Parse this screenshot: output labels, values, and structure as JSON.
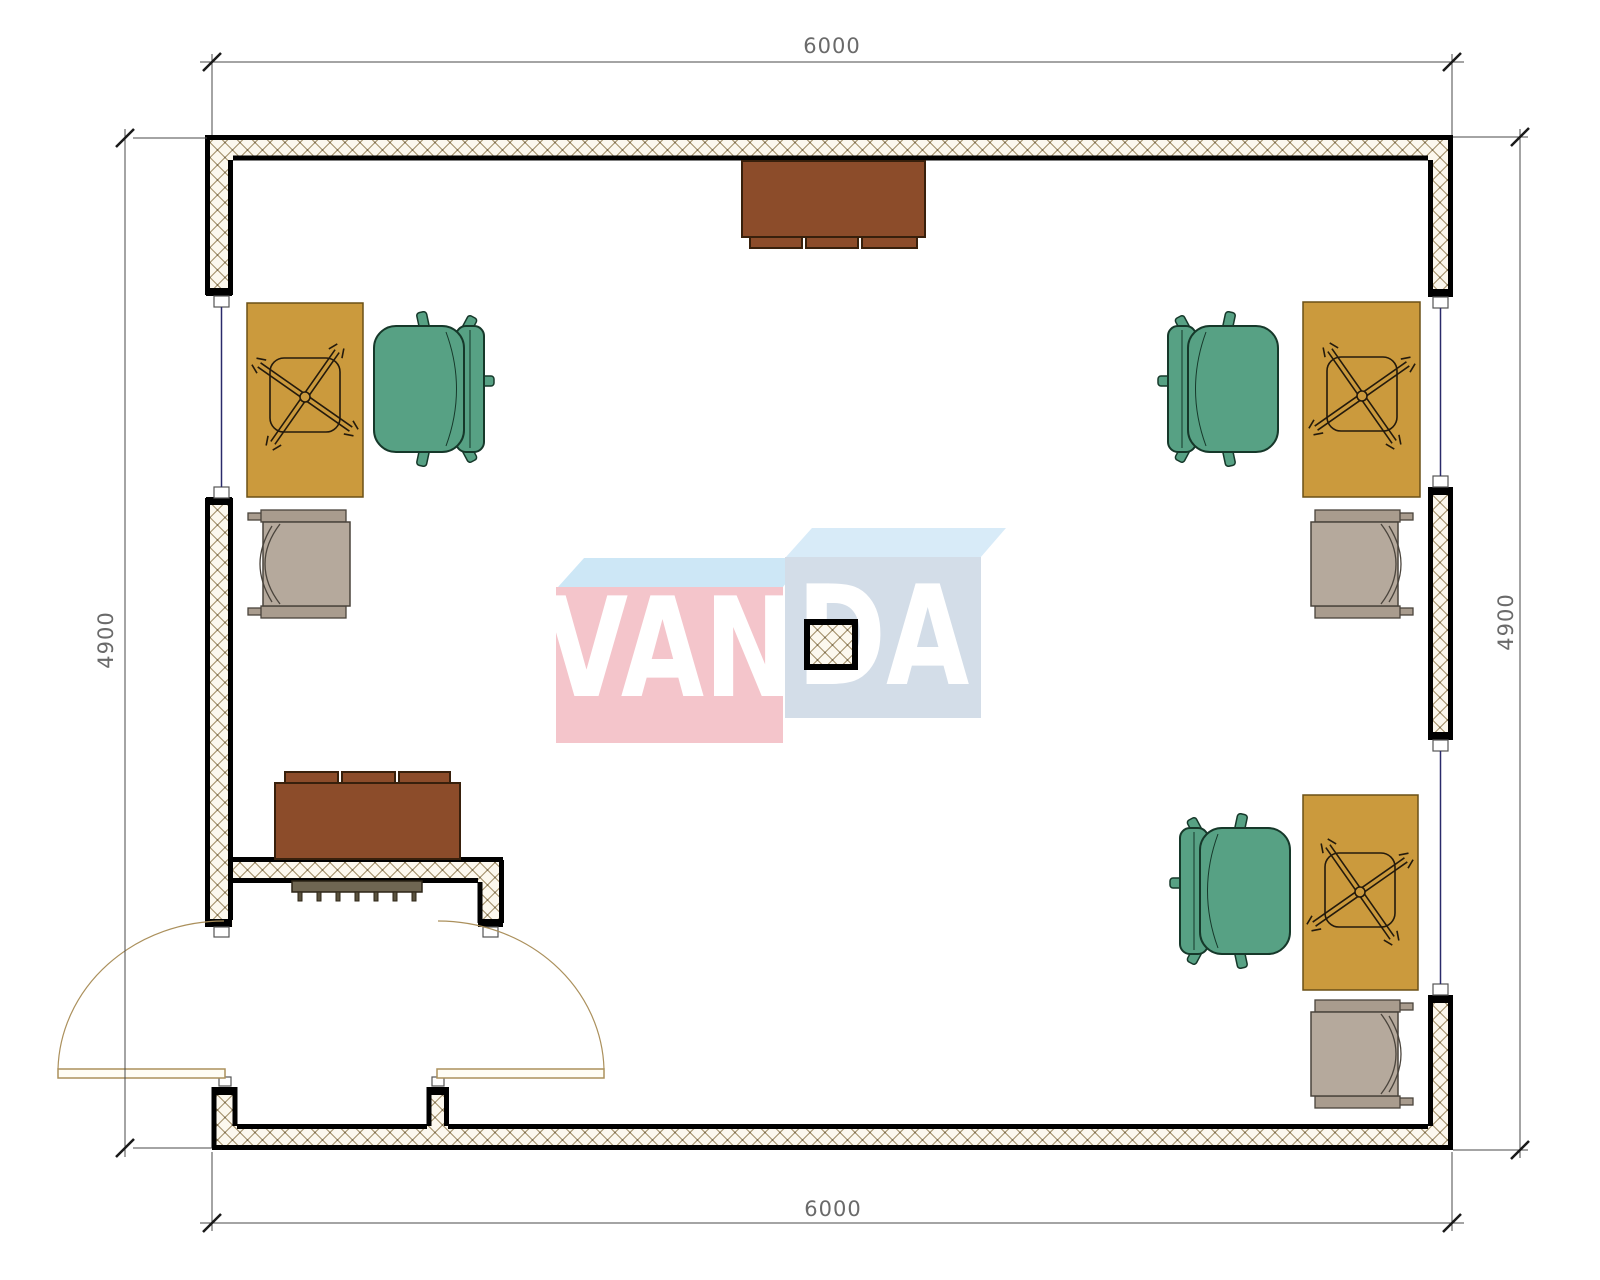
{
  "title": "Room floor plan",
  "dimensions": {
    "top": "6000",
    "bottom": "6000",
    "left": "4900",
    "right": "4900"
  },
  "watermark": {
    "left": "VAN",
    "right": "DA",
    "full": "VANDA"
  },
  "colors": {
    "wall_hatch_line": "#a3906a",
    "wall_outline": "#000000",
    "window_glass": "#2a2a6a",
    "desk": "#cb9a3d",
    "office_chair": "#57a184",
    "armchair": "#b5a99c",
    "cabinet": "#8c4c2a",
    "coat_rack": "#6f6652",
    "door_leaf": "#ab905c",
    "watermark_pink": "#f4c5cb",
    "watermark_blue": "#d3dde8",
    "watermark_top_face": "#cde7f6",
    "dimension_text": "#6a6a6a"
  },
  "furniture": [
    {
      "name": "wardrobe-cabinet-top",
      "type": "cabinet"
    },
    {
      "name": "cabinet-entrance",
      "type": "cabinet"
    },
    {
      "name": "coat-rack",
      "type": "rack"
    },
    {
      "name": "desk-top-left",
      "type": "desk"
    },
    {
      "name": "desk-top-right",
      "type": "desk"
    },
    {
      "name": "desk-bottom-right",
      "type": "desk"
    },
    {
      "name": "office-chair-top-left",
      "type": "office-chair"
    },
    {
      "name": "office-chair-top-right",
      "type": "office-chair"
    },
    {
      "name": "office-chair-bottom-right",
      "type": "office-chair"
    },
    {
      "name": "armchair-top-left",
      "type": "armchair"
    },
    {
      "name": "armchair-top-right",
      "type": "armchair"
    },
    {
      "name": "armchair-bottom-right",
      "type": "armchair"
    },
    {
      "name": "structural-column",
      "type": "column"
    },
    {
      "name": "entrance-double-door",
      "type": "door"
    },
    {
      "name": "window-left",
      "type": "window"
    },
    {
      "name": "window-right-upper",
      "type": "window"
    },
    {
      "name": "window-right-lower",
      "type": "window"
    }
  ]
}
